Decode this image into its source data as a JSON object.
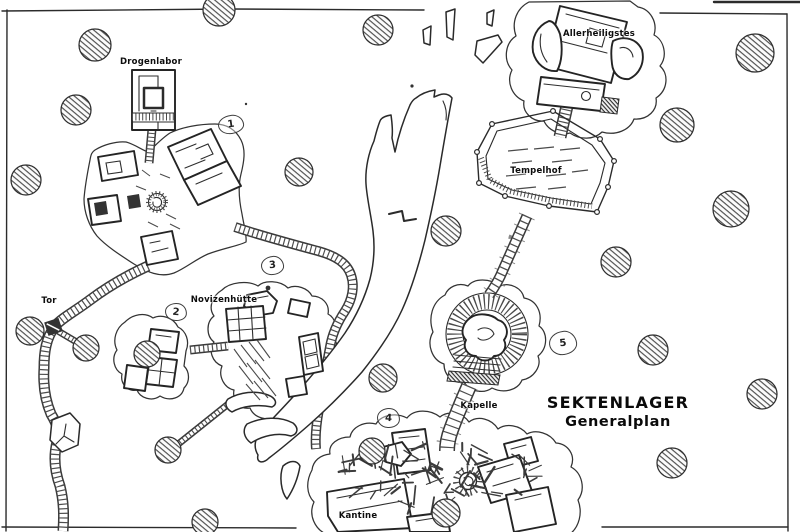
{
  "map": {
    "title": {
      "line1": "SEKTENLAGER",
      "line2": "Generalplan"
    },
    "locations": [
      {
        "id": "drogenlabor",
        "label": "Drogenlabor",
        "x": 151,
        "y": 62
      },
      {
        "id": "allerheiligstes",
        "label": "Allerheiligstes",
        "x": 599,
        "y": 34
      },
      {
        "id": "tempelhof",
        "label": "Tempelhof",
        "x": 536,
        "y": 171
      },
      {
        "id": "novizenhuette",
        "label": "Novizenhütte",
        "x": 224,
        "y": 300
      },
      {
        "id": "tor",
        "label": "Tor",
        "x": 49,
        "y": 301
      },
      {
        "id": "kapelle",
        "label": "Kapelle",
        "x": 479,
        "y": 406
      },
      {
        "id": "kantine",
        "label": "Kantine",
        "x": 358,
        "y": 516
      }
    ],
    "markers": [
      {
        "n": "1",
        "x": 230,
        "y": 123,
        "w": 24,
        "h": 17
      },
      {
        "n": "2",
        "x": 175,
        "y": 311,
        "w": 20,
        "h": 16
      },
      {
        "n": "3",
        "x": 271,
        "y": 264,
        "w": 21,
        "h": 17
      },
      {
        "n": "4",
        "x": 387,
        "y": 417,
        "w": 21,
        "h": 18
      },
      {
        "n": "5",
        "x": 562,
        "y": 342,
        "w": 26,
        "h": 22
      }
    ],
    "trees": [
      {
        "x": 95,
        "y": 45,
        "r": 16
      },
      {
        "x": 219,
        "y": 10,
        "r": 16
      },
      {
        "x": 378,
        "y": 30,
        "r": 15
      },
      {
        "x": 755,
        "y": 53,
        "r": 19
      },
      {
        "x": 76,
        "y": 110,
        "r": 15
      },
      {
        "x": 26,
        "y": 180,
        "r": 15
      },
      {
        "x": 299,
        "y": 172,
        "r": 14
      },
      {
        "x": 677,
        "y": 125,
        "r": 17
      },
      {
        "x": 731,
        "y": 209,
        "r": 18
      },
      {
        "x": 446,
        "y": 231,
        "r": 15
      },
      {
        "x": 616,
        "y": 262,
        "r": 15
      },
      {
        "x": 30,
        "y": 331,
        "r": 14
      },
      {
        "x": 86,
        "y": 348,
        "r": 13
      },
      {
        "x": 147,
        "y": 354,
        "r": 13
      },
      {
        "x": 383,
        "y": 378,
        "r": 14
      },
      {
        "x": 653,
        "y": 350,
        "r": 15
      },
      {
        "x": 168,
        "y": 450,
        "r": 13
      },
      {
        "x": 205,
        "y": 522,
        "r": 13
      },
      {
        "x": 372,
        "y": 451,
        "r": 13
      },
      {
        "x": 446,
        "y": 513,
        "r": 14
      },
      {
        "x": 672,
        "y": 463,
        "r": 15
      },
      {
        "x": 762,
        "y": 394,
        "r": 15
      }
    ],
    "colors": {
      "ink": "#2b2b2b",
      "paper": "#ffffff",
      "hatch": "#4d4d4d"
    }
  }
}
